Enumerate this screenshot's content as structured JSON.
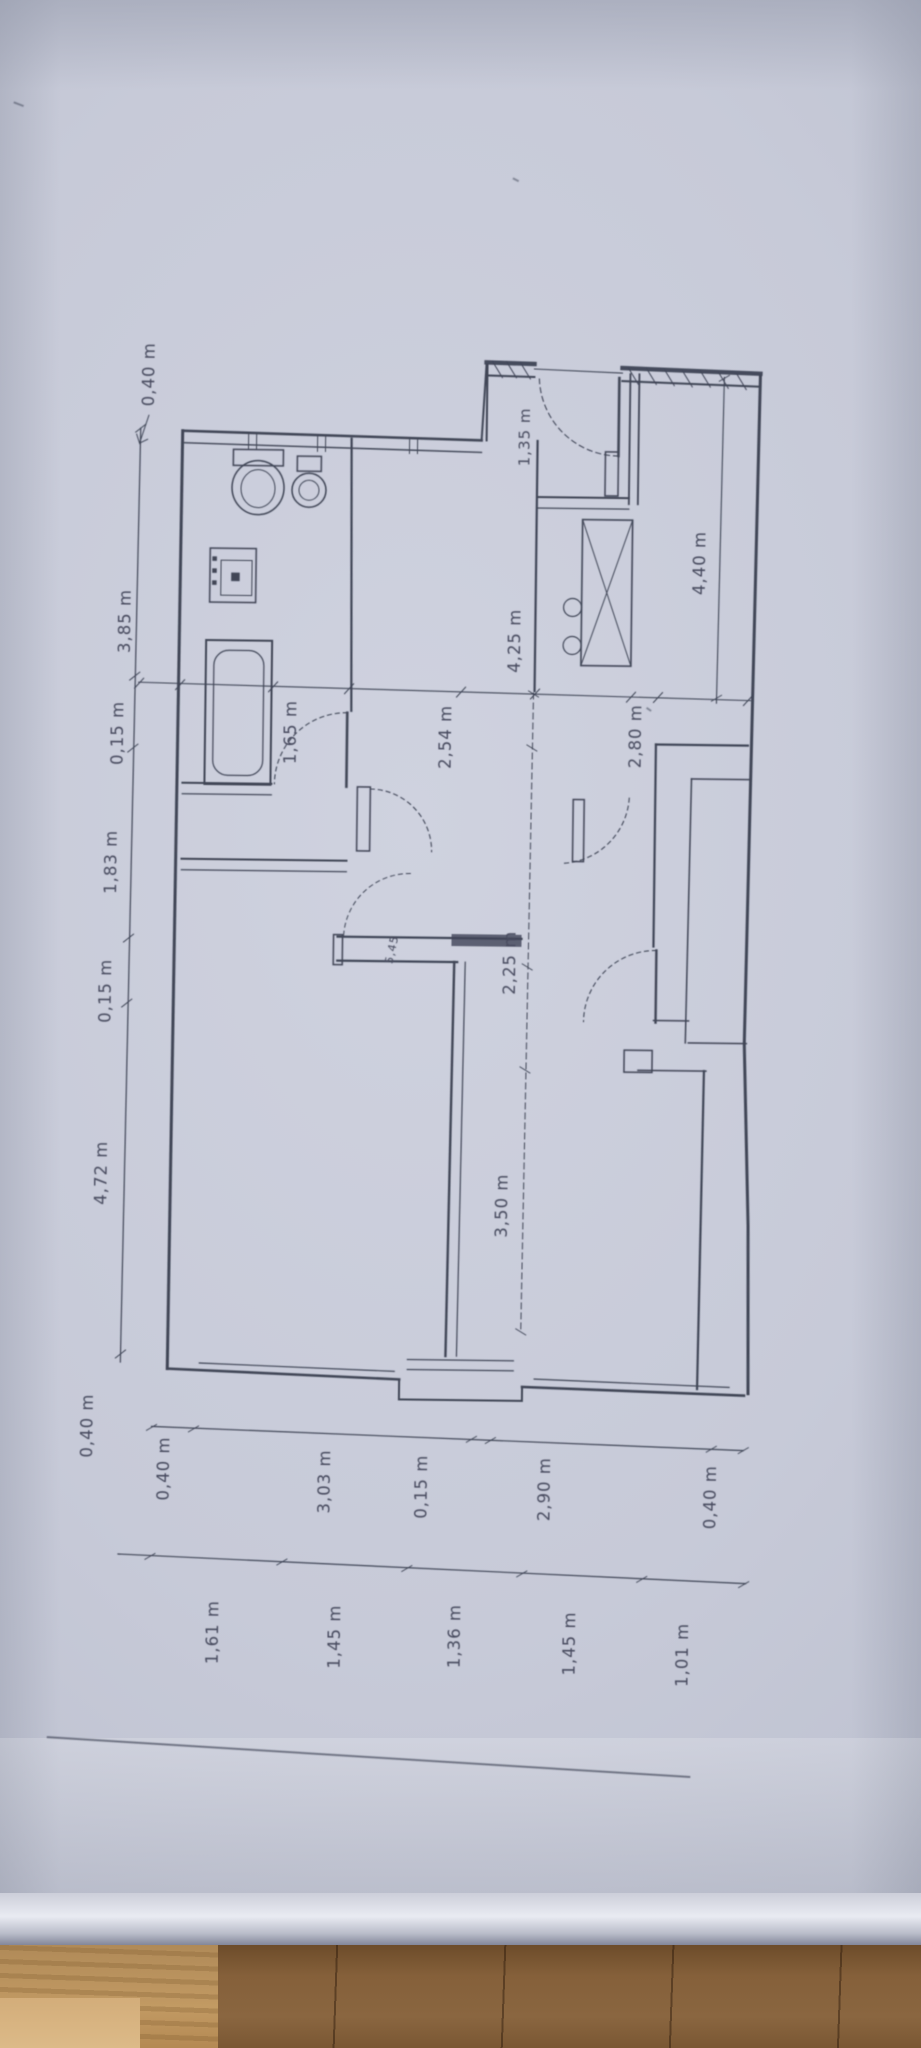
{
  "dimensions": {
    "unit_note": "m",
    "left_chain": [
      "0,40 m",
      "3,85 m",
      "0,15 m",
      "1,83 m",
      "0,15 m",
      "4,72 m",
      "0,40 m"
    ],
    "bottom_chain_outer": [
      "0,40 m",
      "3,03 m",
      "0,15 m",
      "2,90 m",
      "0,40 m"
    ],
    "bottom_chain_inner": [
      "1,61 m",
      "1,45 m",
      "1,36 m",
      "1,45 m",
      "1,01 m"
    ],
    "interior": {
      "vestibule_width": "1,35 m",
      "bathroom_width": "1,65 m",
      "hall_width": "2,54 m",
      "center_span": "4,25 m",
      "right_room_width": "2,80 m",
      "right_side_span": "4,40 m",
      "corridor_span": "2,25 m",
      "left_room_span": "3,50 m",
      "door_mark": "5,45"
    }
  }
}
